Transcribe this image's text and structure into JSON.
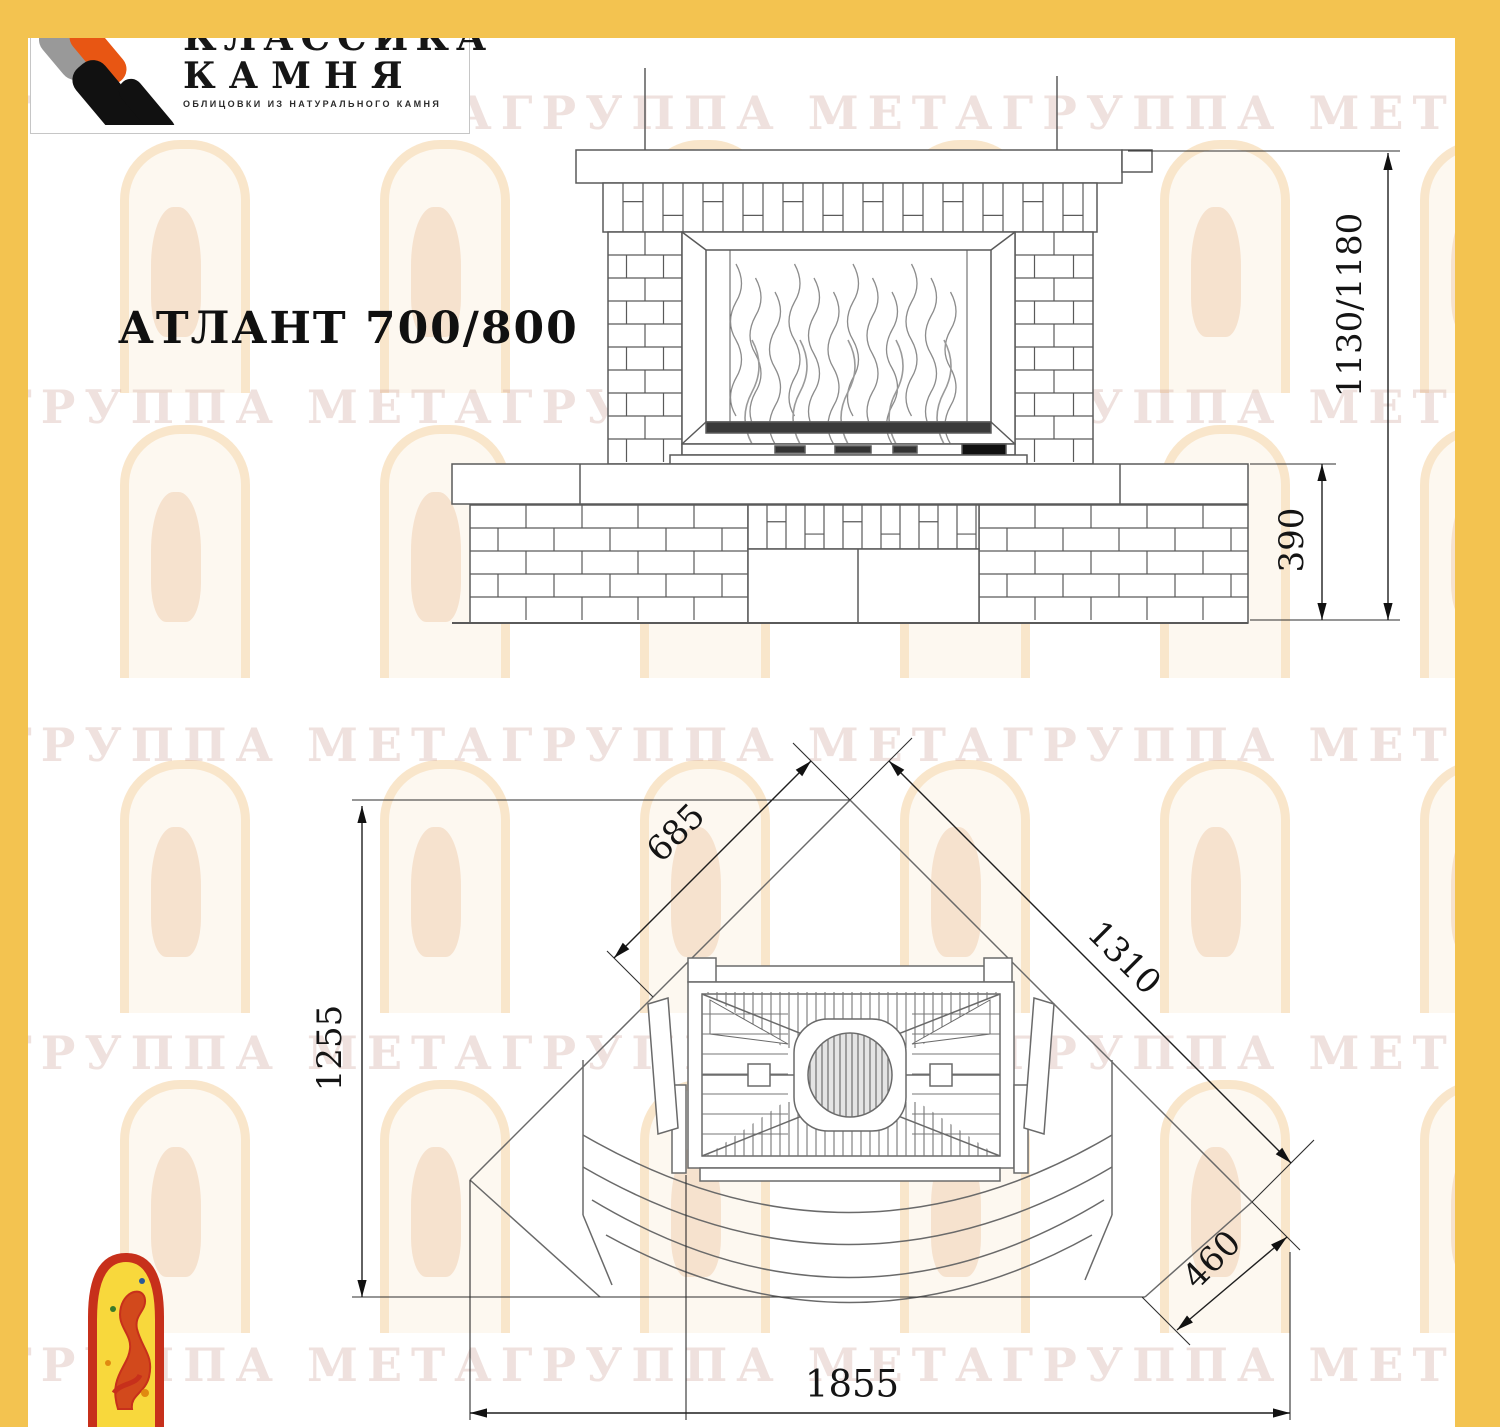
{
  "brand": {
    "logo_line1": "КЛАССИКА",
    "logo_line2": "КАМНЯ",
    "logo_caption": "ОБЛИЦОВКИ ИЗ НАТУРАЛЬНОГО КАМНЯ"
  },
  "title": "АТЛАНТ 700/800",
  "watermark": {
    "text": "ГРУППА МЕТАГРУППА МЕТАГРУППА МЕТАГРУППА МЕТА"
  },
  "front_view": {
    "dims": {
      "height": "1130/1180",
      "base_height": "390"
    }
  },
  "plan_view": {
    "dims": {
      "left_wall": "685",
      "right_diagonal": "1310",
      "depth": "1255",
      "front_right": "460",
      "overall_width": "1855"
    }
  },
  "colors": {
    "frame_yellow": "#F3C350",
    "logo_orange": "#E85613",
    "logo_gray": "#999999",
    "logo_black": "#111111",
    "emblem_red": "#C7301B",
    "emblem_yellow": "#F8D83C",
    "drawing_line": "#5a5a5a"
  }
}
